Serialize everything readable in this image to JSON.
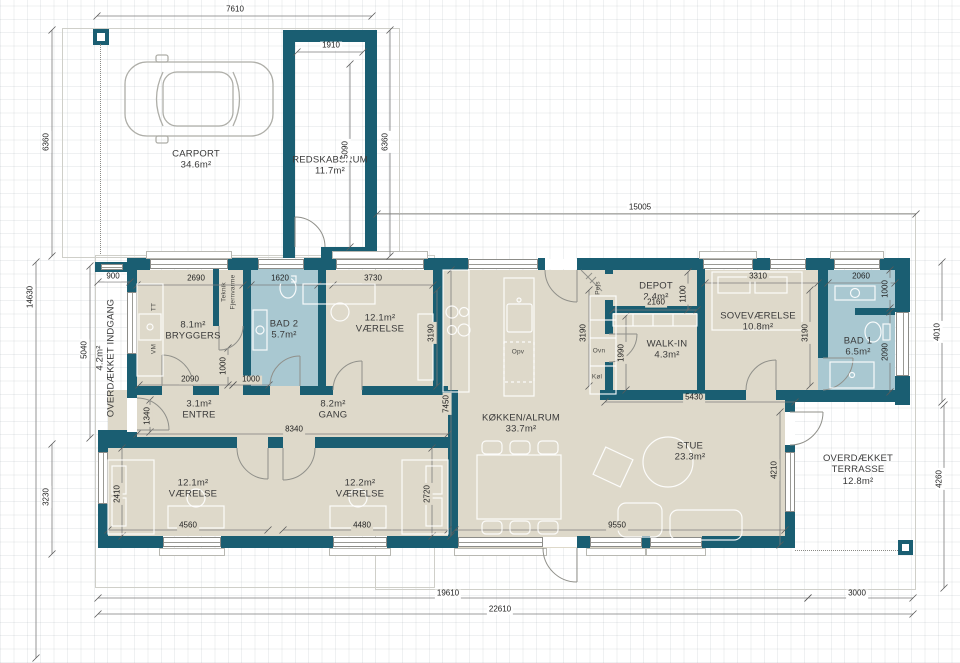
{
  "colors": {
    "wall": "#1a5e72",
    "floor": "#ded9ca",
    "bath_floor": "#a9c8d1",
    "dimension_text": "#222222"
  },
  "rooms": [
    {
      "id": "carport",
      "lines": [
        "CARPORT",
        "34.6m²"
      ],
      "x": 196,
      "y": 160,
      "rot": 0
    },
    {
      "id": "redskabsrum",
      "lines": [
        "REDSKABSRUM",
        "11.7m²"
      ],
      "x": 330,
      "y": 166,
      "rot": 0
    },
    {
      "id": "bryggers",
      "lines": [
        "8.1m²",
        "BRYGGERS"
      ],
      "x": 193,
      "y": 331,
      "rot": 0
    },
    {
      "id": "bad-2",
      "lines": [
        "BAD 2",
        "5.7m²"
      ],
      "x": 284,
      "y": 330,
      "rot": 0
    },
    {
      "id": "vaerelse-nv",
      "lines": [
        "12.1m²",
        "VÆRELSE"
      ],
      "x": 380,
      "y": 324,
      "rot": 0
    },
    {
      "id": "depot",
      "lines": [
        "DEPOT",
        "2.4m²"
      ],
      "x": 656,
      "y": 292,
      "rot": 0
    },
    {
      "id": "walk-in",
      "lines": [
        "WALK-IN",
        "4.3m²"
      ],
      "x": 667,
      "y": 350,
      "rot": 0
    },
    {
      "id": "sovevaerelse",
      "lines": [
        "SOVEVÆRELSE",
        "10.8m²"
      ],
      "x": 758,
      "y": 322,
      "rot": 0
    },
    {
      "id": "bad-1",
      "lines": [
        "BAD 1",
        "6.5m²"
      ],
      "x": 858,
      "y": 347,
      "rot": 0
    },
    {
      "id": "entre",
      "lines": [
        "3.1m²",
        "ENTRE"
      ],
      "x": 199,
      "y": 410,
      "rot": 0
    },
    {
      "id": "gang",
      "lines": [
        "8.2m²",
        "GANG"
      ],
      "x": 333,
      "y": 410,
      "rot": 0
    },
    {
      "id": "koekken-alrum",
      "lines": [
        "KØKKEN/ALRUM",
        "33.7m²"
      ],
      "x": 521,
      "y": 424,
      "rot": 0
    },
    {
      "id": "stue",
      "lines": [
        "STUE",
        "23.3m²"
      ],
      "x": 690,
      "y": 452,
      "rot": 0
    },
    {
      "id": "overdaekket-terrasse",
      "lines": [
        "OVERDÆKKET",
        "TERRASSE",
        "12.8m²"
      ],
      "x": 858,
      "y": 470,
      "rot": 0
    },
    {
      "id": "vaerelse-sv",
      "lines": [
        "12.1m²",
        "VÆRELSE"
      ],
      "x": 193,
      "y": 489,
      "rot": 0
    },
    {
      "id": "vaerelse-so",
      "lines": [
        "12.2m²",
        "VÆRELSE"
      ],
      "x": 360,
      "y": 489,
      "rot": 0
    },
    {
      "id": "overdaekket-indgang",
      "lines": [
        "4.2m²",
        "OVERDÆKKET INDGANG"
      ],
      "x": 106,
      "y": 358,
      "rot": -90
    }
  ],
  "dimensions": [
    {
      "v": "7610",
      "x": 235,
      "y": 10,
      "rot": 0,
      "bg": "bgw"
    },
    {
      "v": "1910",
      "x": 331,
      "y": 46,
      "rot": 0,
      "bg": "bgw"
    },
    {
      "v": "6360",
      "x": 47,
      "y": 142,
      "rot": -90,
      "bg": "bgw"
    },
    {
      "v": "5090",
      "x": 346,
      "y": 150,
      "rot": -90,
      "bg": "bgw"
    },
    {
      "v": "6360",
      "x": 386,
      "y": 142,
      "rot": -90,
      "bg": "bgw"
    },
    {
      "v": "15005",
      "x": 640,
      "y": 208,
      "rot": 0,
      "bg": "bgw"
    },
    {
      "v": "14630",
      "x": 31,
      "y": 297,
      "rot": -90,
      "bg": "bgw"
    },
    {
      "v": "5040",
      "x": 85,
      "y": 350,
      "rot": -90,
      "bg": "bgw"
    },
    {
      "v": "3230",
      "x": 47,
      "y": 497,
      "rot": -90,
      "bg": "bgw"
    },
    {
      "v": "900",
      "x": 113,
      "y": 277,
      "rot": 0,
      "bg": "bgw"
    },
    {
      "v": "2690",
      "x": 196,
      "y": 279,
      "rot": 0,
      "bg": "bgf"
    },
    {
      "v": "1620",
      "x": 280,
      "y": 279,
      "rot": 0,
      "bg": "bgb"
    },
    {
      "v": "3730",
      "x": 373,
      "y": 279,
      "rot": 0,
      "bg": "bgf"
    },
    {
      "v": "3310",
      "x": 758,
      "y": 277,
      "rot": 0,
      "bg": "bgf"
    },
    {
      "v": "2060",
      "x": 861,
      "y": 277,
      "rot": 0,
      "bg": "bgb"
    },
    {
      "v": "3190",
      "x": 432,
      "y": 333,
      "rot": -90,
      "bg": "bgf"
    },
    {
      "v": "3190",
      "x": 584,
      "y": 333,
      "rot": -90,
      "bg": "bgf"
    },
    {
      "v": "3190",
      "x": 806,
      "y": 333,
      "rot": -90,
      "bg": "bgf"
    },
    {
      "v": "1100",
      "x": 684,
      "y": 294,
      "rot": -90,
      "bg": "bgf"
    },
    {
      "v": "2160",
      "x": 656,
      "y": 303,
      "rot": 0,
      "bg": "bgf"
    },
    {
      "v": "1000",
      "x": 886,
      "y": 289,
      "rot": -90,
      "bg": "bgb"
    },
    {
      "v": "2090",
      "x": 886,
      "y": 352,
      "rot": -90,
      "bg": "bgb"
    },
    {
      "v": "4010",
      "x": 938,
      "y": 332,
      "rot": -90,
      "bg": "bgw"
    },
    {
      "v": "2090",
      "x": 190,
      "y": 380,
      "rot": 0,
      "bg": "bgf"
    },
    {
      "v": "1000",
      "x": 224,
      "y": 366,
      "rot": -90,
      "bg": "bgf"
    },
    {
      "v": "1000",
      "x": 251,
      "y": 380,
      "rot": 0,
      "bg": "bgf"
    },
    {
      "v": "1340",
      "x": 148,
      "y": 416,
      "rot": -90,
      "bg": "bgf"
    },
    {
      "v": "8340",
      "x": 294,
      "y": 430,
      "rot": 0,
      "bg": "bgf"
    },
    {
      "v": "7450",
      "x": 447,
      "y": 404,
      "rot": -90,
      "bg": "bgf"
    },
    {
      "v": "1990",
      "x": 622,
      "y": 353,
      "rot": -90,
      "bg": "bgf"
    },
    {
      "v": "5430",
      "x": 694,
      "y": 398,
      "rot": 0,
      "bg": "bgf"
    },
    {
      "v": "2410",
      "x": 118,
      "y": 494,
      "rot": -90,
      "bg": "bgf"
    },
    {
      "v": "4560",
      "x": 188,
      "y": 526,
      "rot": 0,
      "bg": "bgf"
    },
    {
      "v": "4480",
      "x": 362,
      "y": 526,
      "rot": 0,
      "bg": "bgf"
    },
    {
      "v": "2720",
      "x": 428,
      "y": 494,
      "rot": -90,
      "bg": "bgf"
    },
    {
      "v": "9550",
      "x": 617,
      "y": 526,
      "rot": 0,
      "bg": "bgf"
    },
    {
      "v": "4210",
      "x": 775,
      "y": 470,
      "rot": -90,
      "bg": "bgf"
    },
    {
      "v": "4260",
      "x": 940,
      "y": 479,
      "rot": -90,
      "bg": "bgw"
    },
    {
      "v": "19610",
      "x": 448,
      "y": 594,
      "rot": 0,
      "bg": "bgw"
    },
    {
      "v": "3000",
      "x": 857,
      "y": 594,
      "rot": 0,
      "bg": "bgw"
    },
    {
      "v": "22610",
      "x": 500,
      "y": 610,
      "rot": 0,
      "bg": "bgw"
    }
  ],
  "fixture_labels": [
    {
      "t": "TT",
      "x": 154,
      "y": 307,
      "rot": -90
    },
    {
      "t": "VM",
      "x": 154,
      "y": 349,
      "rot": -90
    },
    {
      "t": "Teknik",
      "x": 224,
      "y": 292,
      "rot": -90
    },
    {
      "t": "Fjernvarme",
      "x": 233,
      "y": 292,
      "rot": -90
    },
    {
      "t": "Pejs",
      "x": 598,
      "y": 288,
      "rot": -90
    },
    {
      "t": "Opv",
      "x": 518,
      "y": 352,
      "rot": 0
    },
    {
      "t": "Ovn",
      "x": 599,
      "y": 351,
      "rot": 0
    },
    {
      "t": "Køl",
      "x": 597,
      "y": 377,
      "rot": 0
    }
  ]
}
